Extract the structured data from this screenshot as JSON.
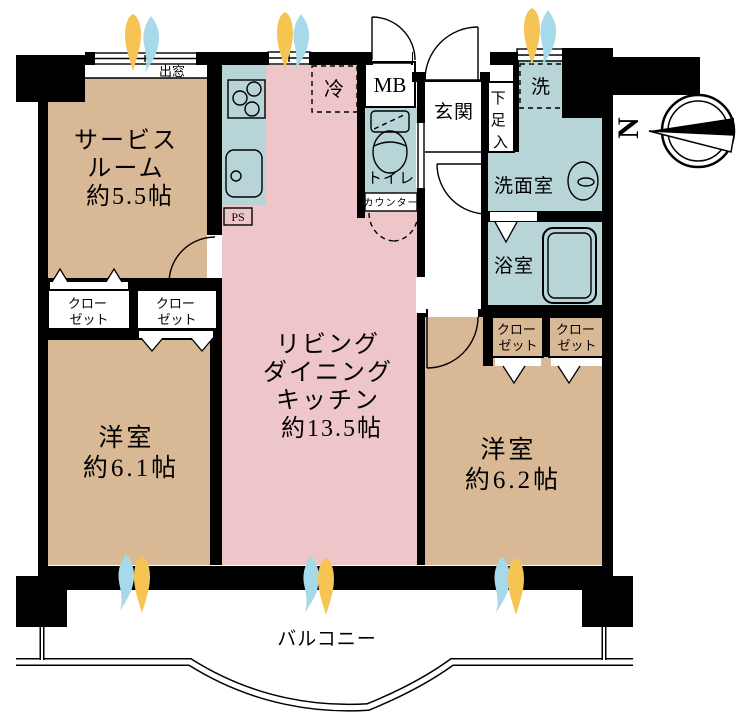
{
  "plan": {
    "colors": {
      "wall_black": "#000000",
      "room_tan": "#d9b995",
      "ldk_pink": "#eec6ca",
      "wet_blue": "#b7d4d7",
      "tub_blue": "#c6dde0",
      "storage_tan": "#ddd1a0",
      "flame_yellow": "#f6c453",
      "flame_blue": "#a6d9e9"
    },
    "rooms": {
      "service_room": {
        "lines": [
          "サービス",
          "ルーム",
          "約5.5帖"
        ]
      },
      "ldk": {
        "lines": [
          "リビング",
          "ダイニング",
          "キッチン",
          "約13.5帖"
        ]
      },
      "west_room": {
        "lines": [
          "洋室",
          "約6.1帖"
        ]
      },
      "east_room": {
        "lines": [
          "洋室",
          "約6.2帖"
        ]
      },
      "entrance": {
        "label": "玄関"
      },
      "toilet": {
        "label": "トイレ"
      },
      "washroom": {
        "label": "洗面室"
      },
      "bathroom": {
        "label": "浴室"
      },
      "balcony": {
        "label": "バルコニー"
      }
    },
    "fixtures": {
      "bay_window": {
        "label": "出窓"
      },
      "refrigerator": {
        "label": "冷"
      },
      "meter_box": {
        "label": "MB"
      },
      "pipe_space_kitchen": {
        "label": "PS"
      },
      "pipe_space_north": {
        "label": "PS"
      },
      "washer": {
        "label": "洗"
      },
      "counter": {
        "label": "カウンター"
      },
      "shoe_box": {
        "chars": [
          "下",
          "足",
          "入"
        ]
      },
      "closets": [
        {
          "lines": [
            "クロー",
            "ゼット"
          ]
        },
        {
          "lines": [
            "クロー",
            "ゼット"
          ]
        },
        {
          "lines": [
            "クロー",
            "ゼット"
          ]
        },
        {
          "lines": [
            "クロー",
            "ゼット"
          ]
        }
      ],
      "compass": {
        "label": "N"
      }
    }
  }
}
